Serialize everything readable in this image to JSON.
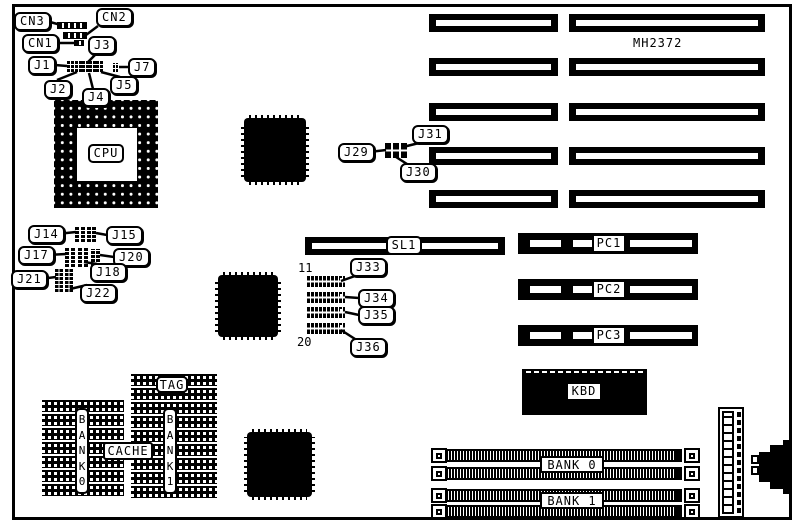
{
  "board": {
    "model": "MH2372"
  },
  "colors": {
    "ink": "#000000",
    "background": "#ffffff"
  },
  "callouts": {
    "cn3": "CN3",
    "cn2": "CN2",
    "cn1": "CN1",
    "j1": "J1",
    "j2": "J2",
    "j3": "J3",
    "j4": "J4",
    "j5": "J5",
    "j7": "J7",
    "j14": "J14",
    "j15": "J15",
    "j17": "J17",
    "j18": "J18",
    "j20": "J20",
    "j21": "J21",
    "j22": "J22",
    "j29": "J29",
    "j30": "J30",
    "j31": "J31",
    "j33": "J33",
    "j34": "J34",
    "j35": "J35",
    "j36": "J36"
  },
  "chips": {
    "cpu": "CPU",
    "kbd": "KBD"
  },
  "slots": {
    "sl1": "SL1",
    "pc1": "PC1",
    "pc2": "PC2",
    "pc3": "PC3"
  },
  "memory": {
    "tag": "TAG",
    "cache": "CACHE",
    "bank0_vertical": "BANK0",
    "bank1_vertical": "BANK1",
    "simm_bank0": "BANK 0",
    "simm_bank1": "BANK 1"
  },
  "jumper_pin_numbers": {
    "first": "11",
    "last": "20"
  }
}
